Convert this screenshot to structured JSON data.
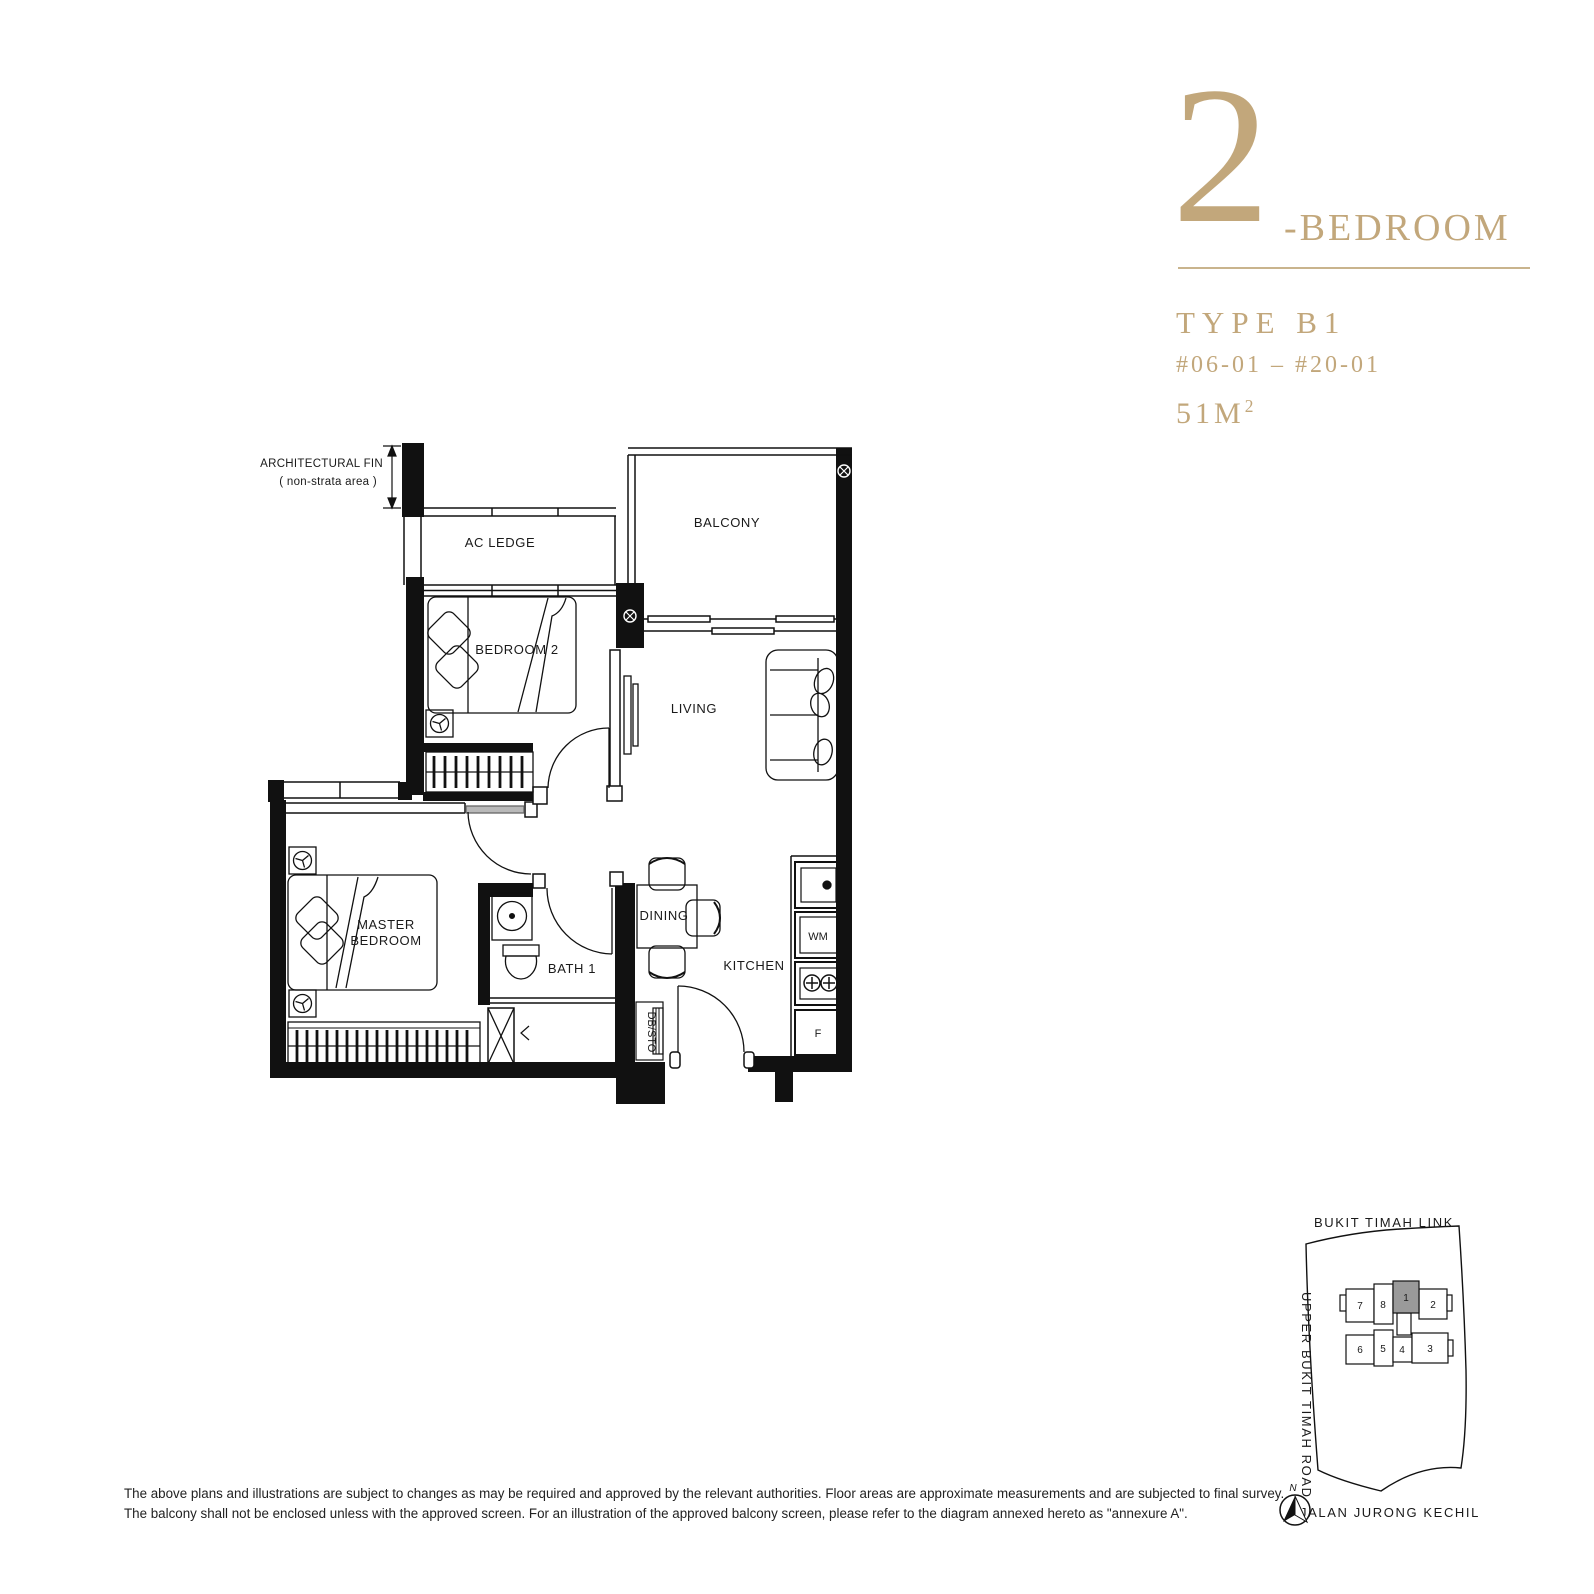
{
  "title_block": {
    "number": "2",
    "suffix": "-BEDROOM",
    "type": "TYPE B1",
    "units": "#06-01 – #20-01",
    "area": "51M",
    "area_sup": "2"
  },
  "floor_plan": {
    "annotation_line1": "ARCHITECTURAL FIN",
    "annotation_line2": "( non-strata area )",
    "rooms": {
      "ac_ledge": "AC LEDGE",
      "balcony": "BALCONY",
      "bedroom2": "BEDROOM 2",
      "living": "LIVING",
      "master_line1": "MASTER",
      "master_line2": "BEDROOM",
      "bath1": "BATH 1",
      "dining": "DINING",
      "kitchen": "KITCHEN",
      "dbsto": "DB/STO"
    },
    "appliances": {
      "washer": "WM",
      "fridge": "F"
    }
  },
  "site_plan": {
    "road_top": "BUKIT TIMAH LINK",
    "road_left": "UPPER BUKIT TIMAH ROAD",
    "road_bottom": "JALAN JURONG KECHIL",
    "north_label": "N",
    "units_top": [
      "7",
      "8",
      "1",
      "2"
    ],
    "units_bottom": [
      "6",
      "5",
      "4",
      "3"
    ],
    "highlighted_unit": "1"
  },
  "disclaimer": {
    "line1": "The above plans and illustrations are subject to changes as may be required and approved by the relevant authorities. Floor areas are approximate measurements and are subjected to final survey.",
    "line2": "The balcony shall not be enclosed unless with the approved screen. For an illustration of the approved balcony screen, please refer to the diagram annexed hereto as \"annexure A\"."
  },
  "colors": {
    "gold": "#C2A77B",
    "line": "#111111",
    "highlight_gray": "#9A9A9A"
  }
}
